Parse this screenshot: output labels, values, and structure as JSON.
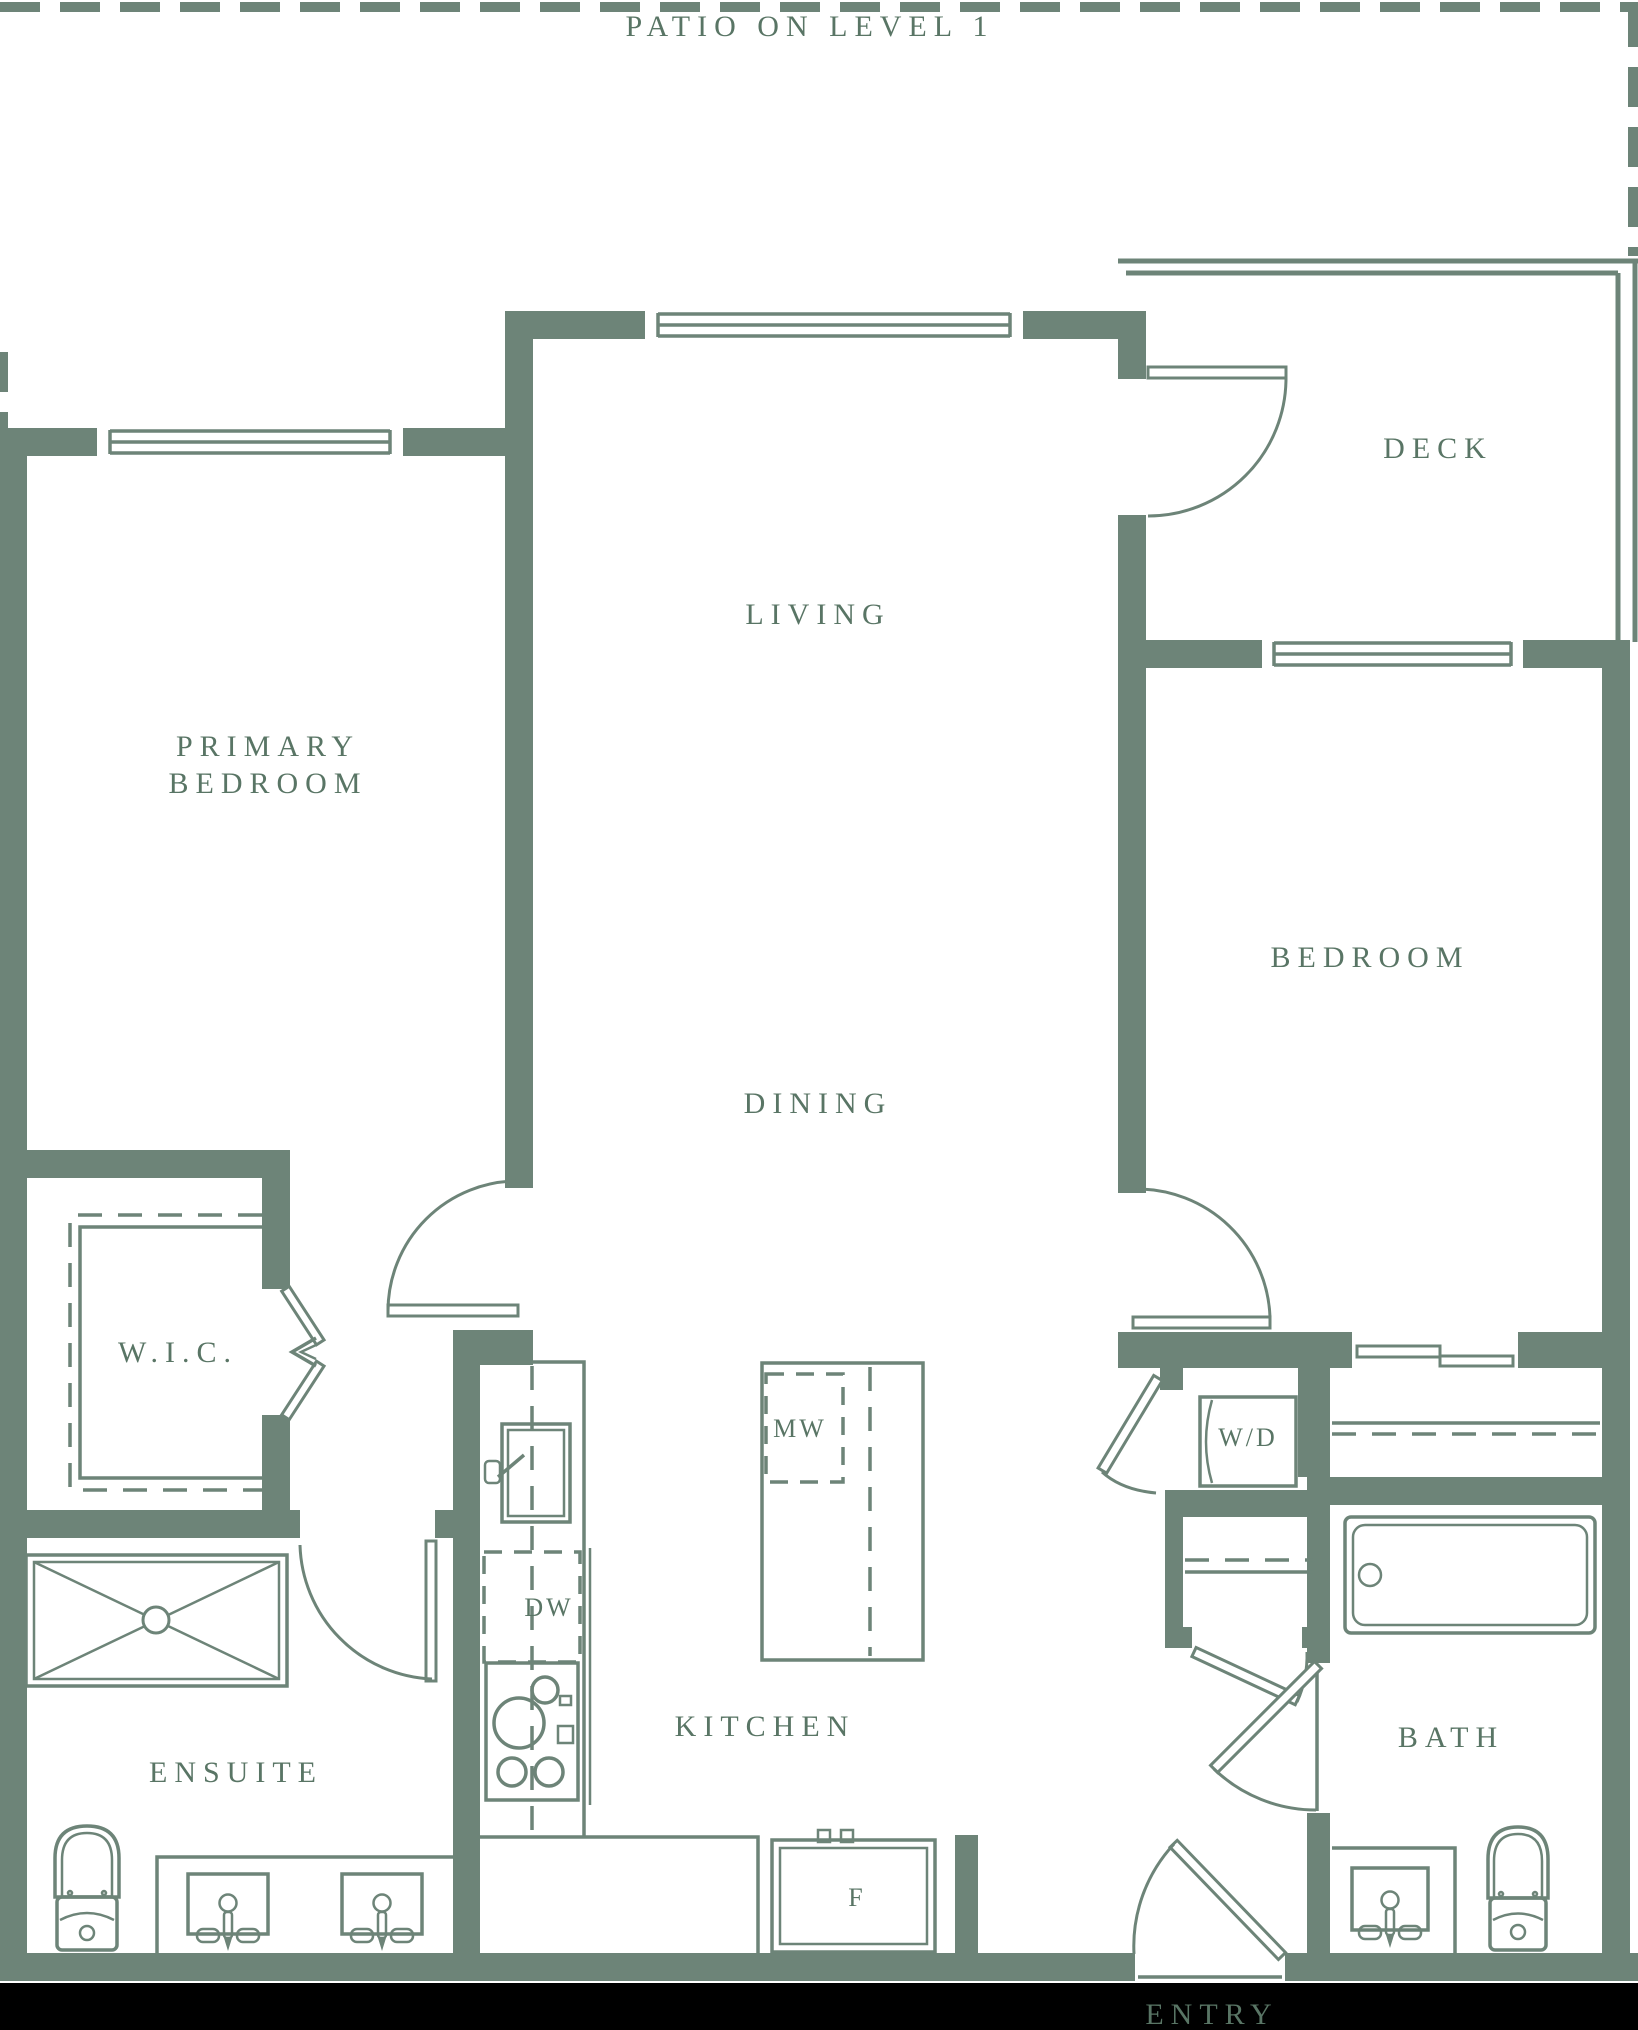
{
  "colors": {
    "wall": "#6d8478",
    "text": "#597565",
    "background": "#ffffff",
    "footer_band": "#000000"
  },
  "labels": {
    "patio": "PATIO ON LEVEL 1",
    "living": "LIVING",
    "dining": "DINING",
    "deck": "DECK",
    "bedroom": "BEDROOM",
    "primary_line1": "PRIMARY",
    "primary_line2": "BEDROOM",
    "wic": "W.I.C.",
    "ensuite": "ENSUITE",
    "kitchen": "KITCHEN",
    "bath": "BATH",
    "entry": "ENTRY",
    "microwave": "MW",
    "dishwasher": "DW",
    "washer_dryer": "W/D",
    "fridge": "F"
  }
}
